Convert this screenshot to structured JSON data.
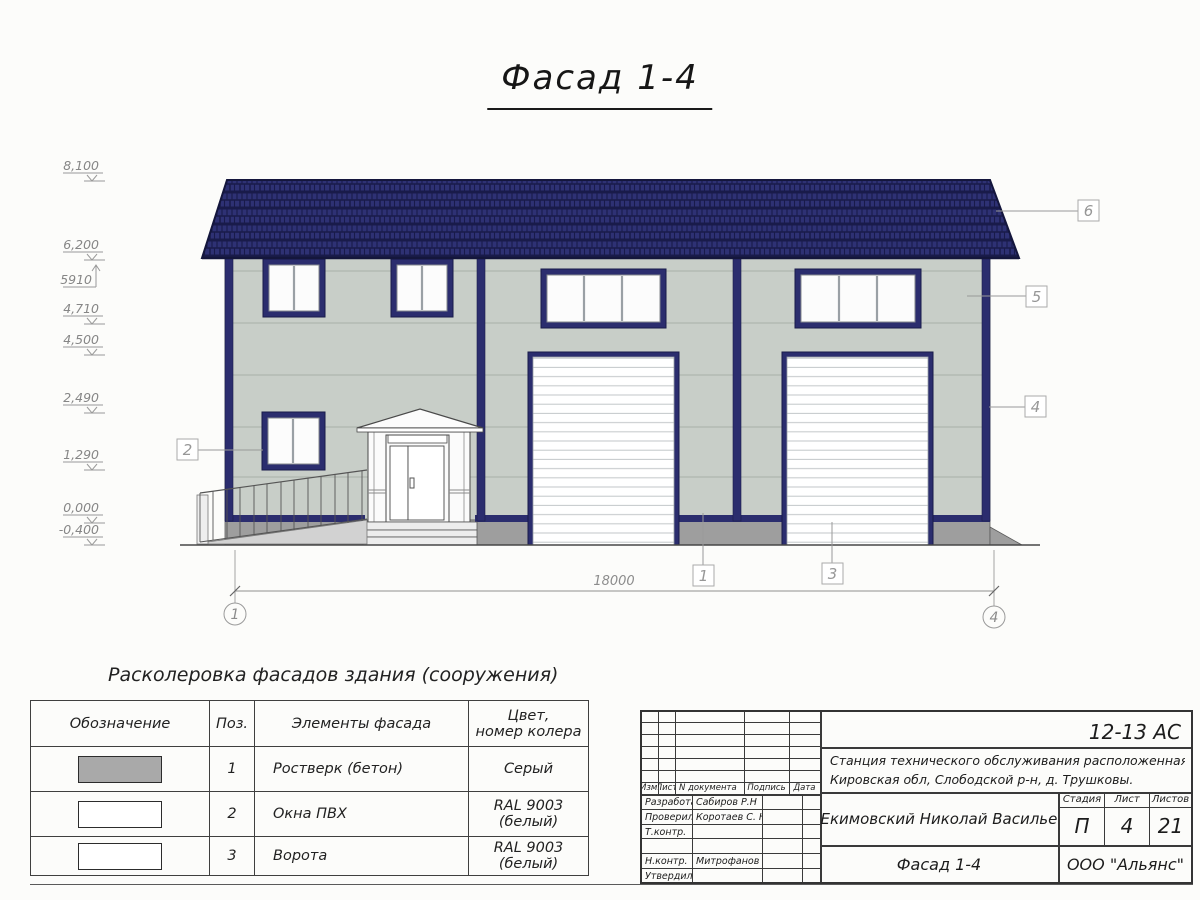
{
  "title": "Фасад 1-4",
  "drawing": {
    "elevations": [
      {
        "value": "8,100"
      },
      {
        "value": "6,200"
      },
      {
        "value": "5910"
      },
      {
        "value": "4,710"
      },
      {
        "value": "4,500"
      },
      {
        "value": "2,490"
      },
      {
        "value": "1,290"
      },
      {
        "value": "0,000"
      },
      {
        "value": "-0,400"
      }
    ],
    "dimension_total": "18000",
    "axes": {
      "left": "1",
      "right": "4"
    },
    "callouts": {
      "c1": "1",
      "c2": "2",
      "c3": "3",
      "c4": "4",
      "c5": "5",
      "c6": "6"
    }
  },
  "legend": {
    "title": "Расколеровка фасадов здания (сооружения)",
    "headers": {
      "designation": "Обозначение",
      "pos": "Поз.",
      "element": "Элементы фасада",
      "color_line1": "Цвет,",
      "color_line2": "номер колера"
    },
    "rows": [
      {
        "pos": "1",
        "element": "Ростверк (бетон)",
        "color": "Серый"
      },
      {
        "pos": "2",
        "element": "Окна ПВХ",
        "color": "RAL 9003 (белый)"
      },
      {
        "pos": "3",
        "element": "Ворота",
        "color": "RAL 9003 (белый)"
      }
    ]
  },
  "stamp": {
    "doc_code": "12-13 АС",
    "object_line1": "Станция технического обслуживания расположенная по адресу",
    "object_line2": "Кировская обл, Слободской р-н, д. Трушковы.",
    "client": "ИП Екимовский Николай Васильевич",
    "sheet_name": "Фасад 1-4",
    "company": "ООО \"Альянс\"",
    "cols": [
      "Изм.",
      "Лист",
      "N документа",
      "Подпись",
      "Дата"
    ],
    "rows": [
      {
        "role": "Разработал",
        "name": "Сабиров Р.Н"
      },
      {
        "role": "Проверил",
        "name": "Коротаев С. Н."
      },
      {
        "role": "Т.контр.",
        "name": ""
      },
      {
        "role": "",
        "name": ""
      },
      {
        "role": "Н.контр.",
        "name": "Митрофанов Я. А."
      },
      {
        "role": "Утвердил",
        "name": ""
      }
    ],
    "stage_label": "Стадия",
    "sheet_label": "Лист",
    "sheets_label": "Листов",
    "stage": "П",
    "sheet": "4",
    "sheets": "21"
  },
  "colors": {
    "roof": "#2e3174",
    "roof_joint": "#191b4a",
    "frame_navy": "#2b2d6e",
    "wall": "#c8cec8",
    "plinth": "#9e9e9e",
    "swatch_gray": "#a9a9a9",
    "white": "#ffffff"
  }
}
